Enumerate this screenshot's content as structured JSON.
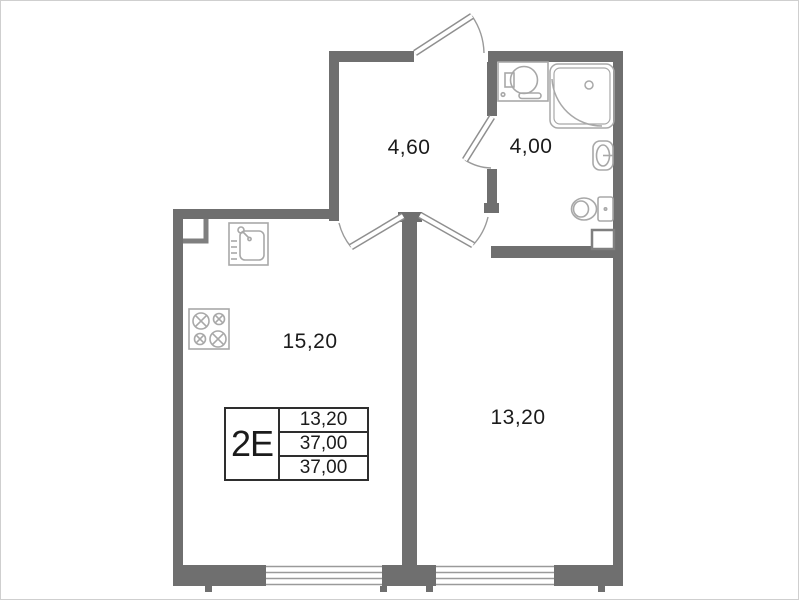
{
  "unit": {
    "label": "2E",
    "stats": [
      "13,20",
      "37,00",
      "37,00"
    ]
  },
  "rooms": {
    "hall": {
      "area": "4,60"
    },
    "bathroom": {
      "area": "4,00"
    },
    "kitchen_living": {
      "area": "15,20"
    },
    "room": {
      "area": "13,20"
    }
  },
  "fixtures": [
    "kitchen-sink-icon",
    "stove-icon",
    "washing-machine-icon",
    "corner-shower-icon",
    "washbasin-icon",
    "toilet-icon",
    "vent-shaft-icon"
  ],
  "doors": [
    "entry-door",
    "kitchen-door",
    "room-door",
    "bathroom-door"
  ],
  "windows": [
    "kitchen-window",
    "room-window"
  ],
  "colors": {
    "background": "#ffffff",
    "wall": "#6f6f6f",
    "fixture_outline": "#a8a8a8",
    "door_leaf": "#8f8f8f",
    "door_arc": "#9a9a9a",
    "text": "#1b1b1b",
    "table_border": "#2e2e2e"
  }
}
